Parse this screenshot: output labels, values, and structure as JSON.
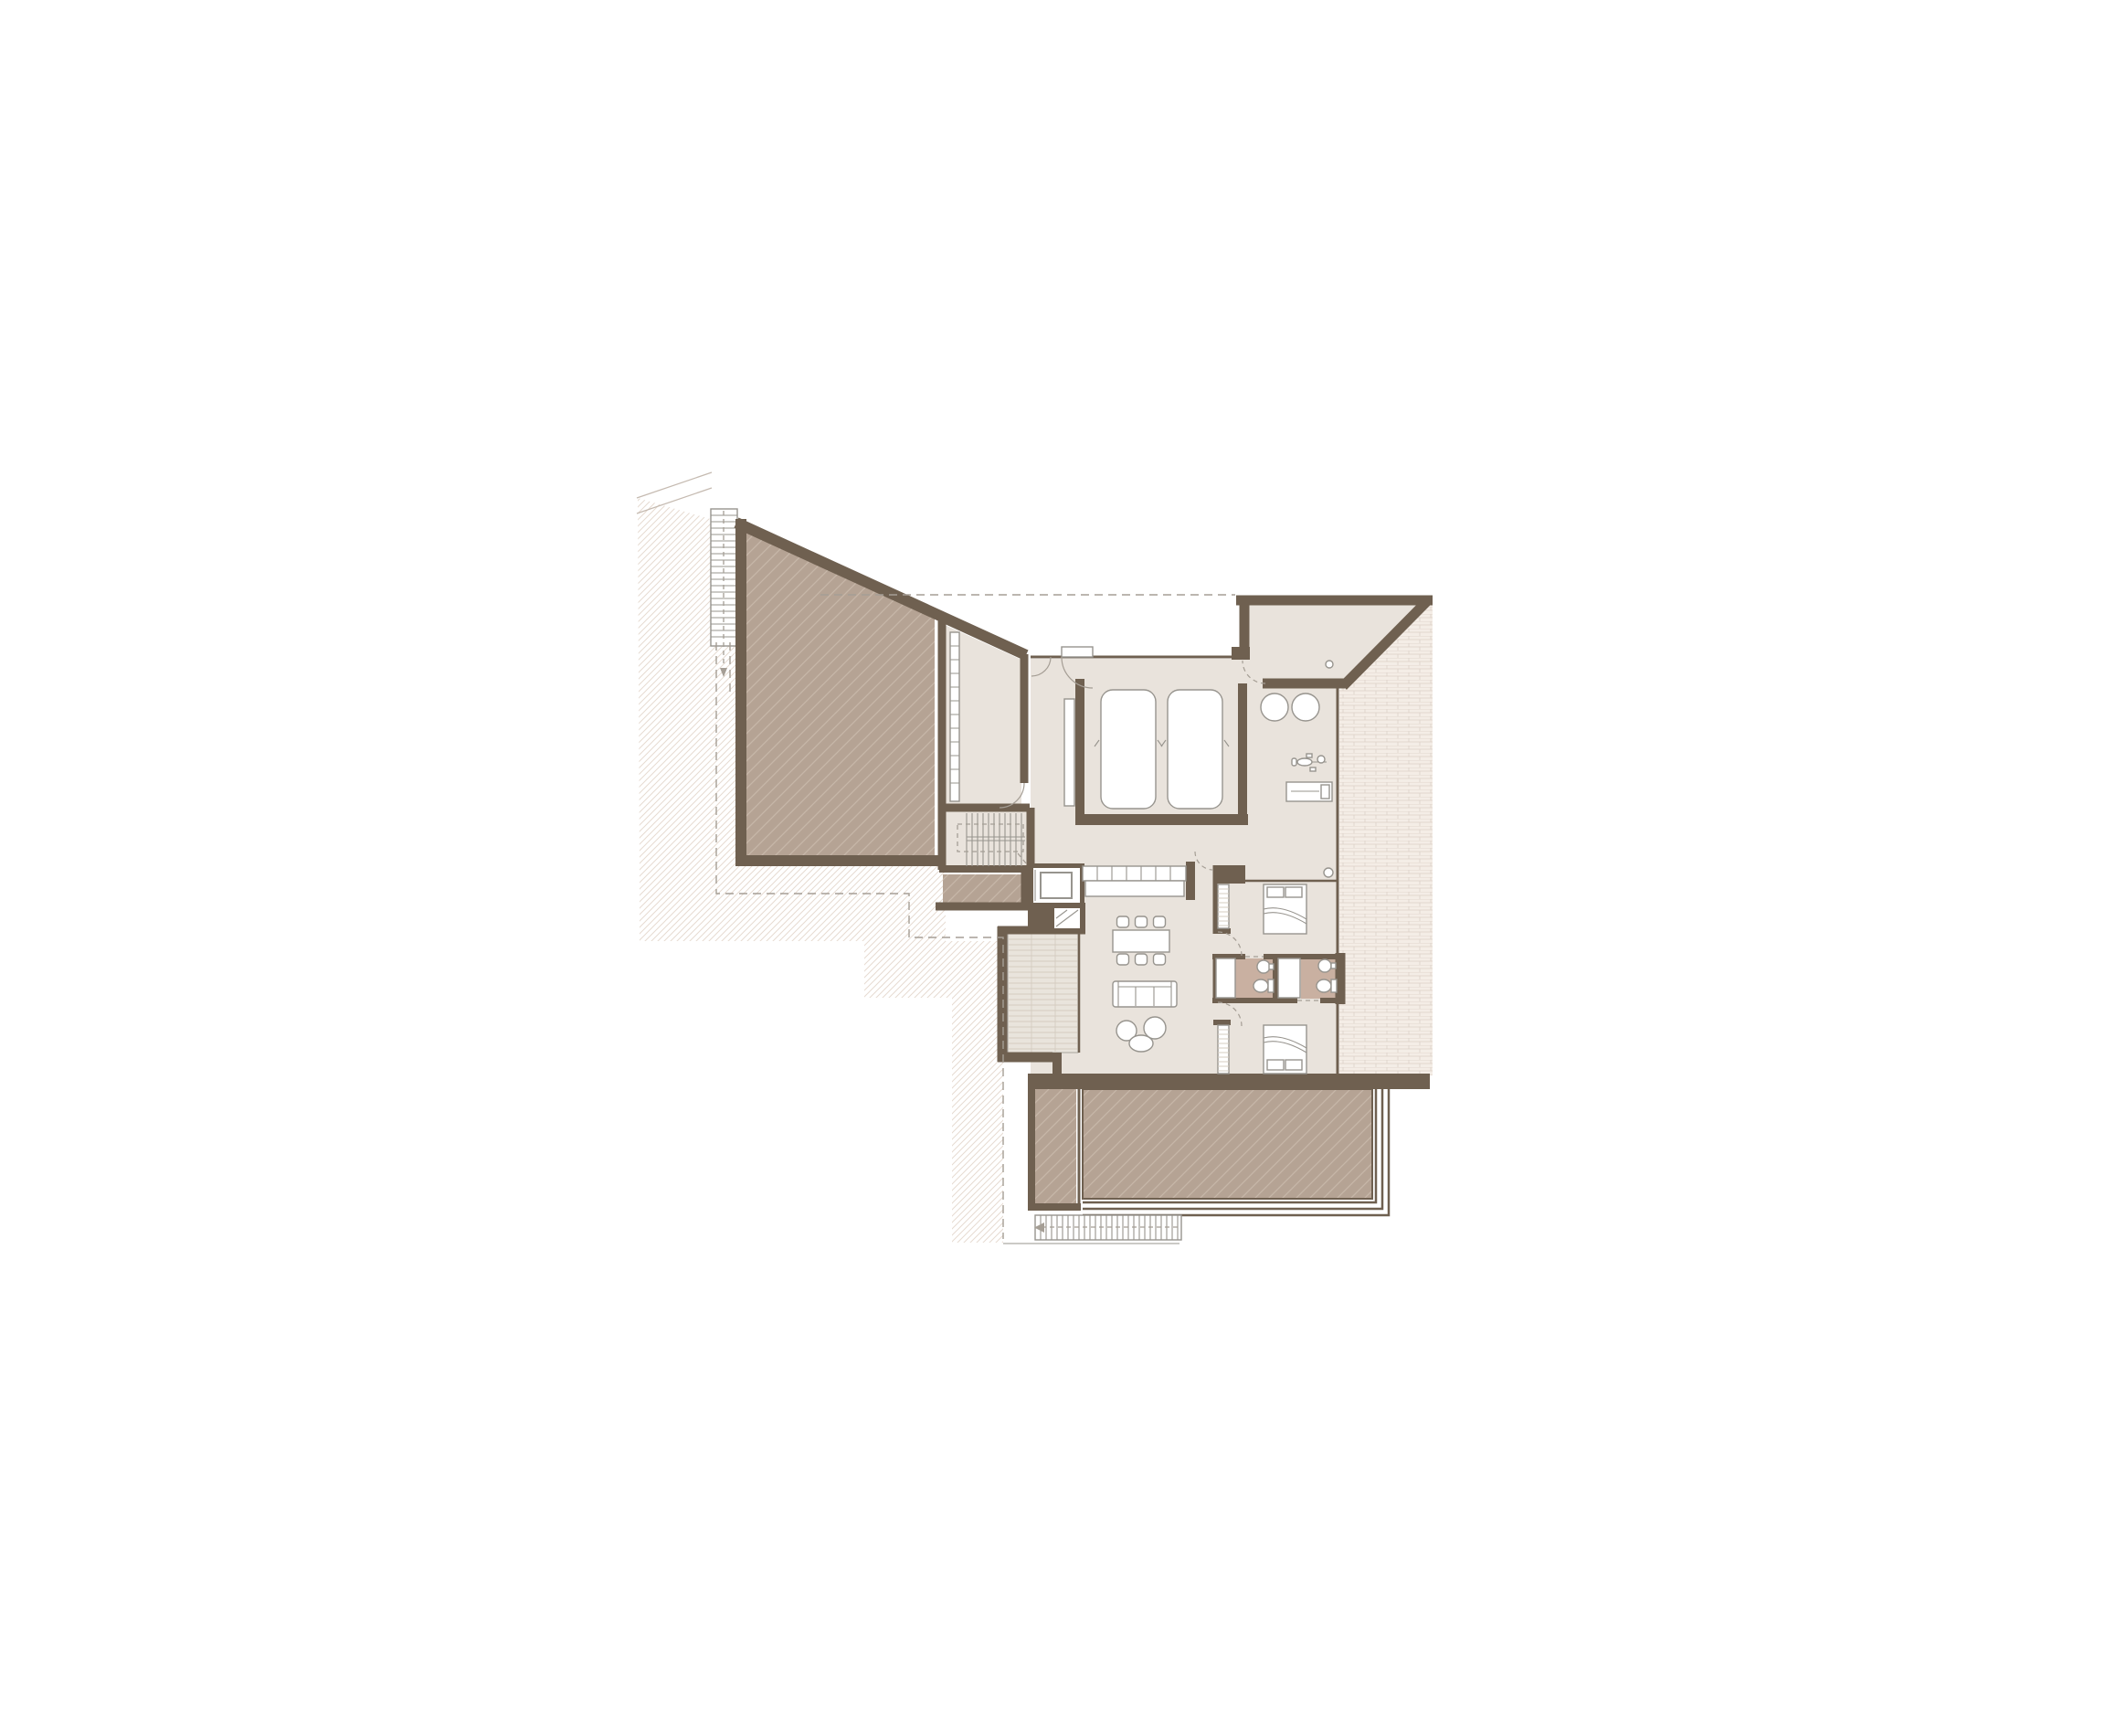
{
  "document": {
    "type": "architectural-floor-plan",
    "visible_text": [],
    "notes": "line drawing only, no text labels rendered in the image"
  },
  "palette": {
    "background": "#ffffff",
    "wall": "#6f6050",
    "floor": "#e9e3dc",
    "deck": "#b5a394",
    "deck_line": "#c6b7a8",
    "ground_line": "#e2d4c9",
    "tile_bg": "#f4ede6",
    "tile_line": "#dcd1c8",
    "bath_floor": "#c9b0a1",
    "balcony_bg": "#e9e4dc",
    "balcony_line": "#d5ccc1",
    "furniture": "#97948e",
    "door_arc": "#a59e95",
    "dash": "#a59e95",
    "site_line": "#c5bab0",
    "white": "#ffffff"
  },
  "plan": {
    "rooms": [
      "upper-deck-terrace",
      "storage-room",
      "main-staircase",
      "entry-hall",
      "garage",
      "entry-porch",
      "gym",
      "kitchen",
      "elevator",
      "living-dining-room",
      "balcony",
      "hallway",
      "bedroom-1",
      "bathroom-1",
      "bathroom-2",
      "bedroom-2",
      "lower-deck-terrace",
      "tiled-terrace",
      "exterior-stairs"
    ],
    "furniture_icons": [
      "car-icon",
      "car-icon",
      "round-stool-icon",
      "round-stool-icon",
      "exercise-bike-icon",
      "workout-bench-icon",
      "kitchen-cabinets-icon",
      "kitchen-island-icon",
      "dining-table-icon",
      "dining-chair-icon",
      "sofa-icon",
      "lounge-chair-icon",
      "coffee-table-icon",
      "bed-icon",
      "bed-icon",
      "toilet-icon",
      "toilet-icon",
      "sink-icon",
      "sink-icon",
      "shower-icon",
      "shower-icon",
      "wardrobe-icon",
      "wardrobe-icon",
      "shelf-icon",
      "stairs-icon",
      "elevator-icon",
      "door-icon"
    ]
  }
}
